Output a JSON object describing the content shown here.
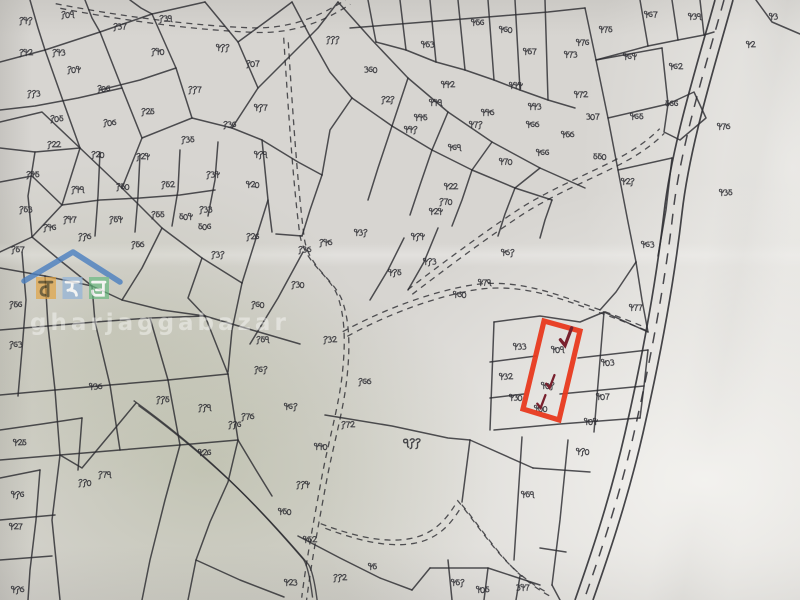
{
  "document": {
    "kind_label": "scanned cadastral parcel map sheet"
  },
  "watermark": {
    "site_text": "gharjaggabazar",
    "roof_color": "#4a7fc0",
    "letters": [
      {
        "char": "घ",
        "tile_color": "#e2a23f",
        "ink": "#5d4a20"
      },
      {
        "char": "ज",
        "tile_color": "#8fb3d9",
        "ink": "#ffffff"
      },
      {
        "char": "ब",
        "tile_color": "#66b87f",
        "ink": "#ffffff"
      }
    ]
  },
  "highlight": {
    "color": "#e8391d",
    "polygon": "544,321 580,331 559,420 523,409",
    "check_color": "#79212e",
    "checks": [
      {
        "x": 560,
        "y": 336,
        "s": 1.25
      },
      {
        "x": 546,
        "y": 381,
        "s": 0.9
      },
      {
        "x": 537,
        "y": 401,
        "s": 0.9
      }
    ]
  },
  "map": {
    "ink": "#2c2c31",
    "labels": [
      {
        "t": "१४१",
        "x": 18,
        "y": 16
      },
      {
        "t": "१०९",
        "x": 60,
        "y": 10
      },
      {
        "t": "१३७",
        "x": 112,
        "y": 22
      },
      {
        "t": "१३९",
        "x": 158,
        "y": 14
      },
      {
        "t": "४११",
        "x": 215,
        "y": 43
      },
      {
        "t": "१४२",
        "x": 18,
        "y": 48
      },
      {
        "t": "१४३",
        "x": 51,
        "y": 48
      },
      {
        "t": "१०४",
        "x": 66,
        "y": 65
      },
      {
        "t": "११३",
        "x": 26,
        "y": 89
      },
      {
        "t": "१०५",
        "x": 49,
        "y": 114
      },
      {
        "t": "१०६",
        "x": 96,
        "y": 84
      },
      {
        "t": "१४०",
        "x": 150,
        "y": 47
      },
      {
        "t": "१०७",
        "x": 245,
        "y": 59
      },
      {
        "t": "११७",
        "x": 187,
        "y": 85
      },
      {
        "t": "४१७",
        "x": 253,
        "y": 103
      },
      {
        "t": "१०८",
        "x": 102,
        "y": 118
      },
      {
        "t": "१२५",
        "x": 140,
        "y": 107
      },
      {
        "t": "१२२",
        "x": 46,
        "y": 140
      },
      {
        "t": "१२०",
        "x": 90,
        "y": 150
      },
      {
        "t": "१२४",
        "x": 135,
        "y": 152
      },
      {
        "t": "१३५",
        "x": 180,
        "y": 135
      },
      {
        "t": "१३६",
        "x": 222,
        "y": 120
      },
      {
        "t": "१४५",
        "x": 25,
        "y": 170
      },
      {
        "t": "१४९",
        "x": 70,
        "y": 185
      },
      {
        "t": "१५०",
        "x": 115,
        "y": 182
      },
      {
        "t": "१५२",
        "x": 160,
        "y": 180
      },
      {
        "t": "१३४",
        "x": 205,
        "y": 170
      },
      {
        "t": "१५३",
        "x": 18,
        "y": 205
      },
      {
        "t": "१४७",
        "x": 62,
        "y": 215
      },
      {
        "t": "१५४",
        "x": 108,
        "y": 215
      },
      {
        "t": "१५५",
        "x": 150,
        "y": 210
      },
      {
        "t": "१३३",
        "x": 198,
        "y": 205
      },
      {
        "t": "१५७",
        "x": 10,
        "y": 245
      },
      {
        "t": "१४६",
        "x": 42,
        "y": 223
      },
      {
        "t": "११८",
        "x": 77,
        "y": 232
      },
      {
        "t": "१५८",
        "x": 130,
        "y": 240
      },
      {
        "t": "१२६",
        "x": 245,
        "y": 232
      },
      {
        "t": "१३१",
        "x": 210,
        "y": 250
      },
      {
        "t": "४१९",
        "x": 253,
        "y": 150
      },
      {
        "t": "४२०",
        "x": 245,
        "y": 180
      },
      {
        "t": "१११",
        "x": 325,
        "y": 35
      },
      {
        "t": "३६०",
        "x": 363,
        "y": 65
      },
      {
        "t": "१२१",
        "x": 380,
        "y": 95
      },
      {
        "t": "४४२",
        "x": 440,
        "y": 80
      },
      {
        "t": "४४९",
        "x": 428,
        "y": 98
      },
      {
        "t": "४४१",
        "x": 403,
        "y": 125
      },
      {
        "t": "४४४",
        "x": 508,
        "y": 81
      },
      {
        "t": "४४८",
        "x": 480,
        "y": 108
      },
      {
        "t": "४७१",
        "x": 468,
        "y": 120
      },
      {
        "t": "४६९",
        "x": 447,
        "y": 143
      },
      {
        "t": "४४३",
        "x": 527,
        "y": 102
      },
      {
        "t": "४६८",
        "x": 525,
        "y": 120
      },
      {
        "t": "४६६",
        "x": 535,
        "y": 148
      },
      {
        "t": "४७०",
        "x": 498,
        "y": 157
      },
      {
        "t": "४२२",
        "x": 443,
        "y": 182
      },
      {
        "t": "१७०",
        "x": 438,
        "y": 197
      },
      {
        "t": "४२४",
        "x": 428,
        "y": 207
      },
      {
        "t": "४४५",
        "x": 413,
        "y": 113
      },
      {
        "t": "४६०",
        "x": 498,
        "y": 25
      },
      {
        "t": "४५७",
        "x": 522,
        "y": 47
      },
      {
        "t": "४५६",
        "x": 470,
        "y": 18
      },
      {
        "t": "४५३",
        "x": 420,
        "y": 40
      },
      {
        "t": "४१५",
        "x": 387,
        "y": 268
      },
      {
        "t": "४१३",
        "x": 422,
        "y": 257
      },
      {
        "t": "४३१",
        "x": 353,
        "y": 228
      },
      {
        "t": "४१४",
        "x": 410,
        "y": 232
      },
      {
        "t": "४७५",
        "x": 598,
        "y": 25
      },
      {
        "t": "४७६",
        "x": 575,
        "y": 38
      },
      {
        "t": "४७३",
        "x": 563,
        "y": 50
      },
      {
        "t": "४६४",
        "x": 622,
        "y": 52
      },
      {
        "t": "४६७",
        "x": 643,
        "y": 10
      },
      {
        "t": "४३९",
        "x": 687,
        "y": 12
      },
      {
        "t": "४२",
        "x": 745,
        "y": 40
      },
      {
        "t": "४६२",
        "x": 668,
        "y": 62
      },
      {
        "t": "४७२",
        "x": 573,
        "y": 90
      },
      {
        "t": "३०७",
        "x": 585,
        "y": 112
      },
      {
        "t": "४६५",
        "x": 629,
        "y": 112
      },
      {
        "t": "५६६",
        "x": 664,
        "y": 99
      },
      {
        "t": "५५०",
        "x": 592,
        "y": 152
      },
      {
        "t": "४२१",
        "x": 620,
        "y": 177
      },
      {
        "t": "४३५",
        "x": 718,
        "y": 188
      },
      {
        "t": "४७८",
        "x": 716,
        "y": 122
      },
      {
        "t": "४६३",
        "x": 640,
        "y": 240
      },
      {
        "t": "४५८",
        "x": 560,
        "y": 130
      },
      {
        "t": "४३",
        "x": 768,
        "y": 12
      },
      {
        "t": "४०९",
        "x": 550,
        "y": 345
      },
      {
        "t": "४०१",
        "x": 540,
        "y": 381
      },
      {
        "t": "४००",
        "x": 533,
        "y": 404
      },
      {
        "t": "४३३",
        "x": 512,
        "y": 342
      },
      {
        "t": "४३२",
        "x": 498,
        "y": 372
      },
      {
        "t": "४३०",
        "x": 508,
        "y": 393
      },
      {
        "t": "४०३",
        "x": 600,
        "y": 358
      },
      {
        "t": "४०७",
        "x": 595,
        "y": 392
      },
      {
        "t": "४०४",
        "x": 583,
        "y": 417
      },
      {
        "t": "४७७",
        "x": 628,
        "y": 303
      },
      {
        "t": "४८१",
        "x": 500,
        "y": 248
      },
      {
        "t": "४७९",
        "x": 477,
        "y": 278
      },
      {
        "t": "४८०",
        "x": 452,
        "y": 290
      },
      {
        "t": "४१०",
        "x": 575,
        "y": 447
      },
      {
        "t": "५०६",
        "x": 197,
        "y": 222
      },
      {
        "t": "५०४",
        "x": 178,
        "y": 212
      },
      {
        "t": "१६०",
        "x": 250,
        "y": 300
      },
      {
        "t": "१५९",
        "x": 255,
        "y": 335
      },
      {
        "t": "१६१",
        "x": 253,
        "y": 365
      },
      {
        "t": "४३८",
        "x": 88,
        "y": 382
      },
      {
        "t": "११५",
        "x": 155,
        "y": 395
      },
      {
        "t": "१७८",
        "x": 240,
        "y": 412
      },
      {
        "t": "११६",
        "x": 227,
        "y": 420
      },
      {
        "t": "११९",
        "x": 197,
        "y": 403
      },
      {
        "t": "११०",
        "x": 77,
        "y": 478
      },
      {
        "t": "१७९",
        "x": 97,
        "y": 470
      },
      {
        "t": "४२६",
        "x": 197,
        "y": 448
      },
      {
        "t": "४२५",
        "x": 12,
        "y": 438
      },
      {
        "t": "४१६",
        "x": 10,
        "y": 490
      },
      {
        "t": "१३८",
        "x": 297,
        "y": 245
      },
      {
        "t": "१४८",
        "x": 318,
        "y": 238
      },
      {
        "t": "१३०",
        "x": 290,
        "y": 280
      },
      {
        "t": "१३२",
        "x": 322,
        "y": 335
      },
      {
        "t": "१६८",
        "x": 357,
        "y": 377
      },
      {
        "t": "१७२",
        "x": 340,
        "y": 420
      },
      {
        "t": "११४",
        "x": 295,
        "y": 480
      },
      {
        "t": "४६१",
        "x": 283,
        "y": 402
      },
      {
        "t": "४४०",
        "x": 313,
        "y": 442
      },
      {
        "t": "९११",
        "x": 402,
        "y": 437,
        "s": 0.8
      },
      {
        "t": "४५९",
        "x": 520,
        "y": 490
      },
      {
        "t": "४५१",
        "x": 450,
        "y": 578
      },
      {
        "t": "४५",
        "x": 367,
        "y": 562
      },
      {
        "t": "११२",
        "x": 332,
        "y": 573
      },
      {
        "t": "४२३",
        "x": 283,
        "y": 578
      },
      {
        "t": "४५२",
        "x": 302,
        "y": 535
      },
      {
        "t": "४५०",
        "x": 277,
        "y": 507
      },
      {
        "t": "४०५",
        "x": 475,
        "y": 585
      },
      {
        "t": "३४७",
        "x": 515,
        "y": 583
      },
      {
        "t": "४२७",
        "x": 8,
        "y": 522
      },
      {
        "t": "४१८",
        "x": 10,
        "y": 585
      },
      {
        "t": "१५६",
        "x": 8,
        "y": 300
      },
      {
        "t": "१६३",
        "x": 8,
        "y": 340
      }
    ],
    "lines": [
      "0,62 45,50 100,32 152,14 205,2",
      "45,50 62,98 80,148 62,205 32,237 0,252",
      "100,32 122,88 142,138 122,188 80,148",
      "152,14 176,68 192,118 142,138",
      "205,2 238,42 258,88 232,128 192,118",
      "0,122 42,112 80,148",
      "0,182 32,176 62,205",
      "32,237 62,262 92,286 122,300 162,310 205,316",
      "122,188 162,228 202,258 242,283",
      "232,128 262,140 298,162 322,175",
      "258,88 288,58 318,28 338,2",
      "238,42 268,20 292,2",
      "162,228 142,268 122,300",
      "202,258 188,298 205,316",
      "242,283 232,330 228,372",
      "122,88 78,98 35,106 0,110",
      "176,68 140,80 100,90",
      "30,0 38,28 45,50",
      "85,0 92,18 100,32",
      "130,0 141,8 152,14",
      "0,148 35,152 80,148",
      "35,152 28,196 32,237",
      "100,152 98,196 95,236",
      "140,155 138,196 135,232",
      "180,150 178,190 172,226",
      "218,142 215,180 208,216",
      "62,205 100,200 140,198 180,195 215,190",
      "262,140 268,200 272,232",
      "268,200 242,283",
      "322,175 310,210 302,236",
      "302,236 276,234",
      "250,344 278,298 303,252",
      "292,2 312,40 330,72 352,98",
      "338,2 372,40 408,78 448,112 492,142 540,168 585,188",
      "352,98 392,126 432,150 472,170 515,188 552,200",
      "408,78 392,126",
      "448,112 432,150",
      "492,142 472,170",
      "540,168 515,188",
      "352,98 330,130 322,175",
      "392,126 378,168 368,200",
      "432,150 420,185 410,215",
      "472,170 462,200 452,226",
      "515,188 505,214 498,236",
      "552,200 545,220 540,238",
      "368,0 376,42",
      "400,0 406,50",
      "430,0 436,62",
      "458,0 465,70",
      "488,0 494,80",
      "515,0 520,90",
      "545,0 548,100",
      "350,28 400,24 450,20 500,16 548,12 585,8",
      "376,42 406,50 436,62 465,70 494,80 520,90 548,100 575,108",
      "585,8 596,60 608,118 618,170 628,222 636,262",
      "596,60 662,48",
      "608,118 668,104",
      "618,170 672,158",
      "662,48 668,104",
      "640,0 648,46",
      "672,0 678,40",
      "700,0 704,35",
      "596,60 648,46 678,40 704,35 714,32",
      "668,104 694,92 706,118 680,140 664,132 668,104",
      "636,262 616,292 600,310",
      "636,262 642,300 648,332",
      "672,158 666,210 658,256",
      "494,322 490,430",
      "604,312 594,432",
      "490,362 536,356",
      "490,398 524,394",
      "494,430 560,424 640,418",
      "578,358 648,350",
      "560,394 644,386",
      "604,312 648,332",
      "648,350 644,386 640,418",
      "494,322 540,316 580,322 604,312",
      "568,440 560,520 552,585",
      "533,468 590,472",
      "522,437 514,560",
      "470,440 462,502",
      "325,415 392,426 448,438 470,440",
      "470,440 533,468",
      "448,560 452,600",
      "488,568 484,600",
      "520,576 516,600",
      "430,568 488,568 540,585",
      "552,585 560,600",
      "540,548 566,552",
      "205,316 252,330 300,344",
      "0,268 45,276 92,286",
      "0,330 48,326 95,322 150,318 205,316",
      "0,395 55,390 110,385 168,380 228,374",
      "0,460 60,455 120,450 180,445 238,440",
      "45,276 48,326",
      "92,286 95,322",
      "48,326 55,390",
      "95,322 110,385",
      "150,318 168,380",
      "205,316 228,374",
      "55,390 60,455",
      "110,385 120,450",
      "168,380 180,445",
      "228,374 238,440",
      "238,440 256,470 272,496",
      "180,445 165,500 150,560 142,600",
      "238,440 228,482 210,522 196,560 188,600",
      "60,455 52,520 58,580 60,600",
      "0,520 55,515",
      "0,560 52,556",
      "136,403 112,432 82,468 60,455",
      "0,478 40,470",
      "40,470 36,520 30,570 28,600",
      "0,430 42,424 82,418",
      "82,418 78,470",
      "404,238 388,270 370,300",
      "438,228 424,262 408,290",
      "298,536 340,558 380,578 412,590",
      "412,590 430,568",
      "196,560 240,580 284,597",
      "756,0 772,22 800,34",
      "22,252 26,300 22,350 18,396"
    ],
    "trails": [
      "M58,6 C130,20 200,28 250,30 C290,32 320,20 348,2",
      "M286,40 C291,120 296,190 302,236 C306,264 330,276 339,296 C347,316 348,342 345,372 C342,406 331,442 324,480 C317,518 309,560 304,600",
      "M345,334 C376,317 422,297 470,288 C520,279 562,298 602,312 C618,318 634,324 646,329",
      "M410,292 C444,266 484,236 522,211 C552,192 584,179 614,164 C638,152 652,141 662,131",
      "M323,526 C352,537 384,546 412,541 C440,536 452,516 460,503 C472,517 492,547 512,567 C524,579 538,589 550,595"
    ],
    "road_center": "M724,0 C707,62 681,143 673,213 C665,283 650,363 634,433 C618,503 597,563 584,600",
    "canal": "M136,403 C165,424 195,448 225,476 C255,504 282,534 306,562 C310,568 313,584 315,600"
  }
}
